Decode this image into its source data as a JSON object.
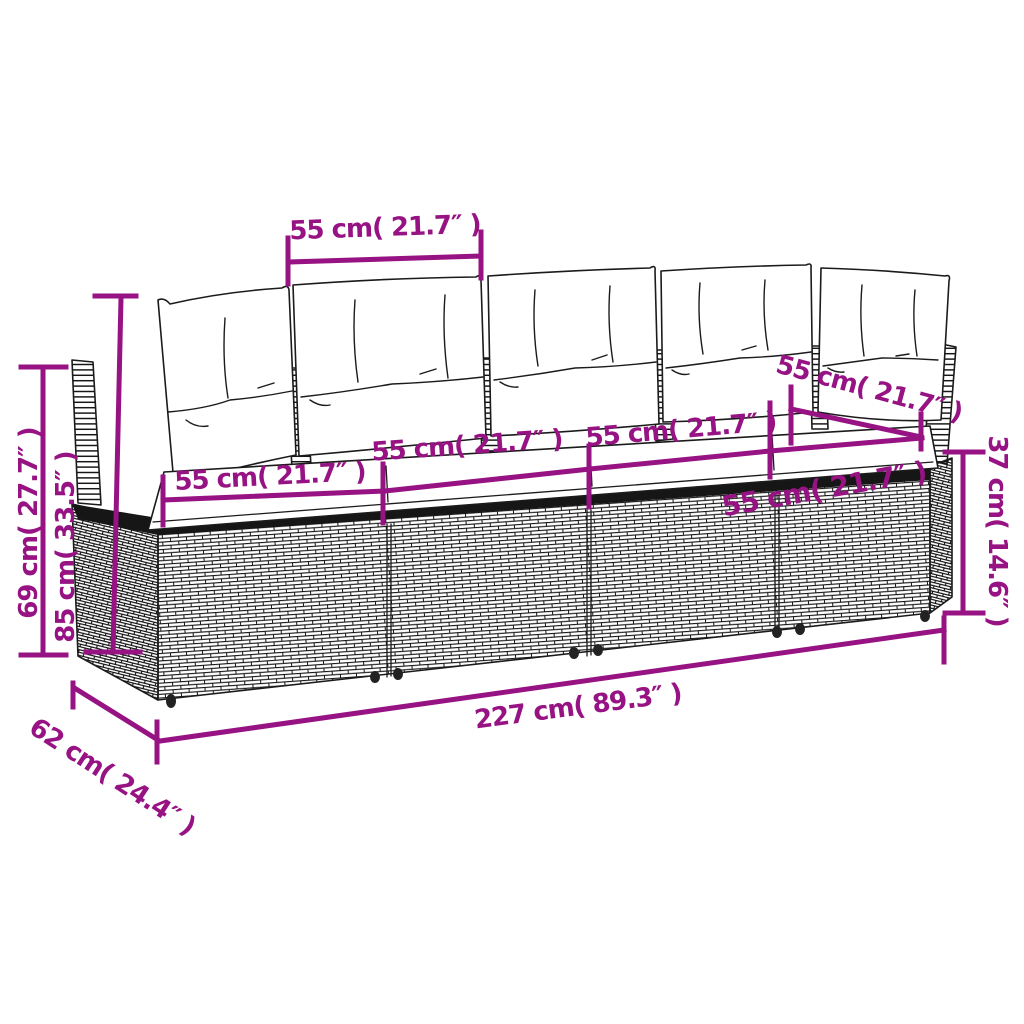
{
  "diagram": {
    "subject": "4-seater poly rattan garden sofa with back and seat cushions",
    "style": "line-art dimension sketch"
  },
  "colors": {
    "dimension_accent": "#971283",
    "line_art": "#1b1b1b",
    "background": "#ffffff"
  },
  "annotations": {
    "top_back_cushion_width": "55 cm( 21.7″ )",
    "seat_1_width": "55 cm( 21.7″ )",
    "seat_2_width": "55 cm( 21.7″ )",
    "seat_3_width": "55 cm( 21.7″ )",
    "seat_4_width": "55 cm( 21.7″ )",
    "right_back_cushion_width": "55 cm( 21.7″ )",
    "back_height": "69 cm( 27.7″ )",
    "overall_height": "85 cm( 33.5″ )",
    "base_height": "37 cm( 14.6″ )",
    "total_width": "227 cm( 89.3″ )",
    "depth": "62 cm( 24.4″ )"
  }
}
